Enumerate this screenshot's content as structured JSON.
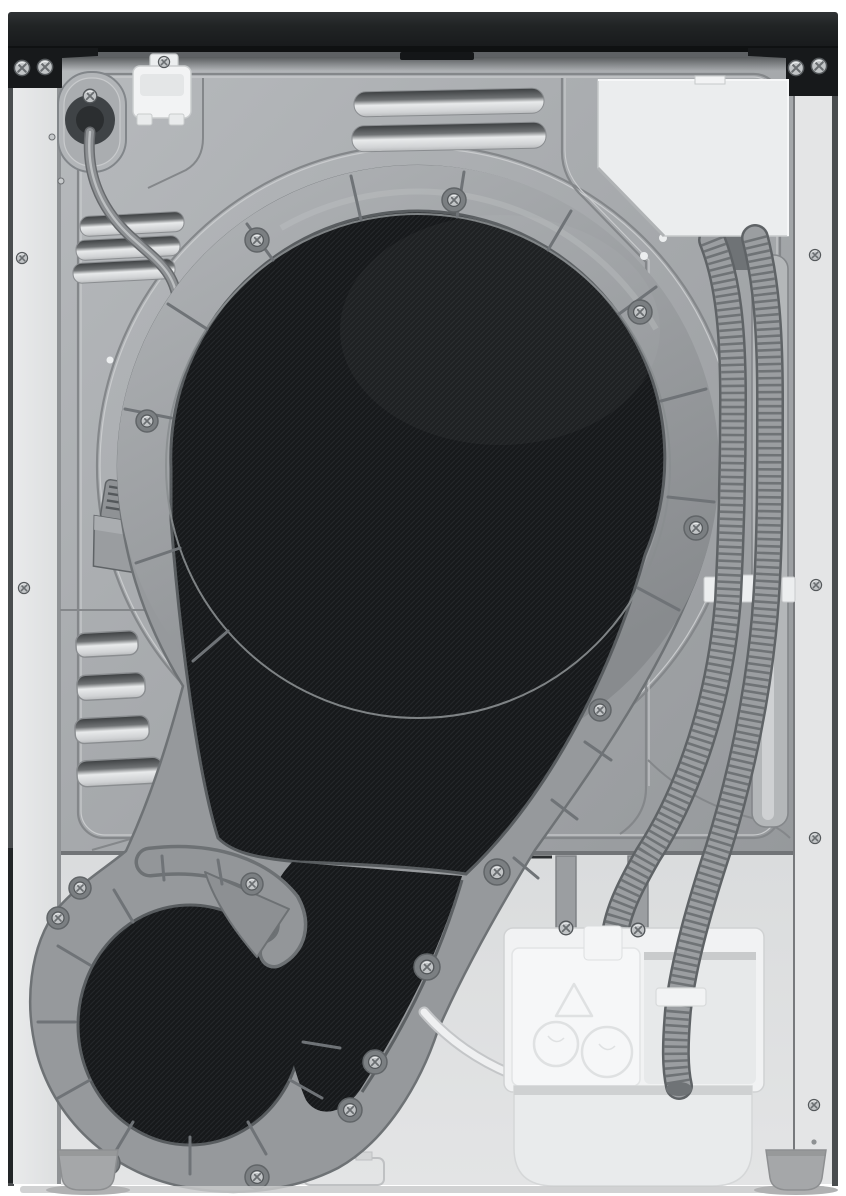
{
  "scene": {
    "type": "product-photo",
    "subject": "Rear view of a heat-pump tumble dryer",
    "orientation": "portrait",
    "background": "#ffffff"
  },
  "palette": {
    "bg": "#ffffff",
    "trim_dark": "#17191b",
    "trim_mid": "#2b2e30",
    "metal": "#a6a9ac",
    "metal_hi": "#b7babd",
    "metal_lo": "#96999c",
    "groove": "#84878a",
    "groove_hi": "#c9cbcd",
    "edge_strip": "#e9eaeb",
    "duct": "#96999c",
    "duct_hi": "#adb0b3",
    "duct_lo": "#6e7275",
    "duct_edge": "#595d60",
    "mesh": "#17191b",
    "mesh_line": "#24272a",
    "panel_lower": "#dadcdd",
    "white_part": "#f2f3f4",
    "white_part_dim": "#e7e9ea",
    "hose": "#9b9ea1",
    "hose_rib": "#6f7376",
    "hose_dark": "#5f6366",
    "cord": "#8d9093",
    "screw": "#c2c5c7",
    "screw_dark": "#4c4f52",
    "foot": "#a5a7a9",
    "shadow": "#c9cacb"
  },
  "parts": {
    "top_trim": {
      "label": "black top trim bar"
    },
    "corner_brackets": {
      "label": "black corner brackets with screws"
    },
    "left_edge": {
      "label": "left side panel edge"
    },
    "right_edge": {
      "label": "right side panel edge"
    },
    "rear_panel": {
      "label": "embossed metal rear panel"
    },
    "lower_panel": {
      "label": "lower service panel"
    },
    "top_vents": {
      "label": "top louver vents",
      "count": 2
    },
    "upper_left_vents": {
      "label": "upper-left louver vents",
      "count": 3
    },
    "lower_left_vents": {
      "label": "lower-left louver vents",
      "count": 4
    },
    "power_inlet": {
      "label": "power cord inlet grommet"
    },
    "cord_clip": {
      "label": "white cord retainer clip"
    },
    "power_cord": {
      "label": "power cord"
    },
    "power_plug": {
      "label": "power plug"
    },
    "drum_cover": {
      "label": "black mesh drum / duct cover"
    },
    "air_duct": {
      "label": "grey rear air duct ring"
    },
    "duct_spiral": {
      "label": "blower duct spiral (bottom-left)"
    },
    "access_plate": {
      "label": "upper-right access plate"
    },
    "hose_inner": {
      "label": "corrugated drain hose (inner)"
    },
    "hose_outer": {
      "label": "corrugated drain hose (outer)"
    },
    "hose_clips": {
      "label": "white hose retaining clips",
      "count": 4
    },
    "condensate_unit": {
      "label": "white condensate pump housing"
    },
    "condensate_tray": {
      "label": "condensate tray"
    },
    "overflow_hose": {
      "label": "thin white overflow hose"
    },
    "feet": {
      "label": "leveling feet",
      "count": 2
    },
    "screws": {
      "label": "phillips screws",
      "visible_count": 31
    }
  }
}
